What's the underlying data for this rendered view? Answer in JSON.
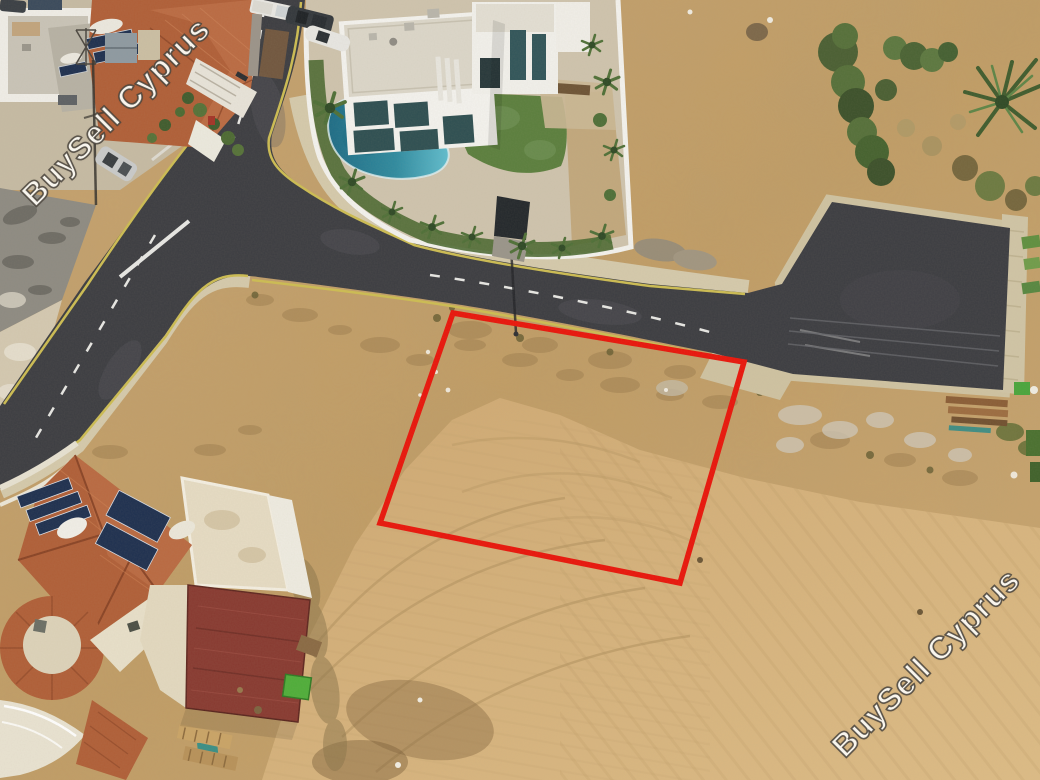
{
  "watermarks": [
    {
      "text": "BuySell Cyprus",
      "position": "top-left"
    },
    {
      "text": "BuySell Cyprus",
      "position": "bottom-right"
    }
  ],
  "plot": {
    "outline_color": "#e9150b"
  },
  "colors": {
    "plot-red": "#e9150b",
    "asphalt": "#3c3d42",
    "asphalt-old": "#8e8b83",
    "dirt": "#c5a26b",
    "field": "#d4af78",
    "sidewalk": "#d5caac",
    "road-yellow": "#cdbd53",
    "marking-white": "#e8e8e5",
    "pool-blue": "#2f8ba0",
    "lawn-green": "#5b7f3e",
    "tile-orange": "#b05f38",
    "roof-maroon": "#883a31",
    "wall-white": "#f4f3ef",
    "wall-cream": "#e6dcc4",
    "tree-green": "#45622f",
    "solar-blue": "#1e3050"
  }
}
